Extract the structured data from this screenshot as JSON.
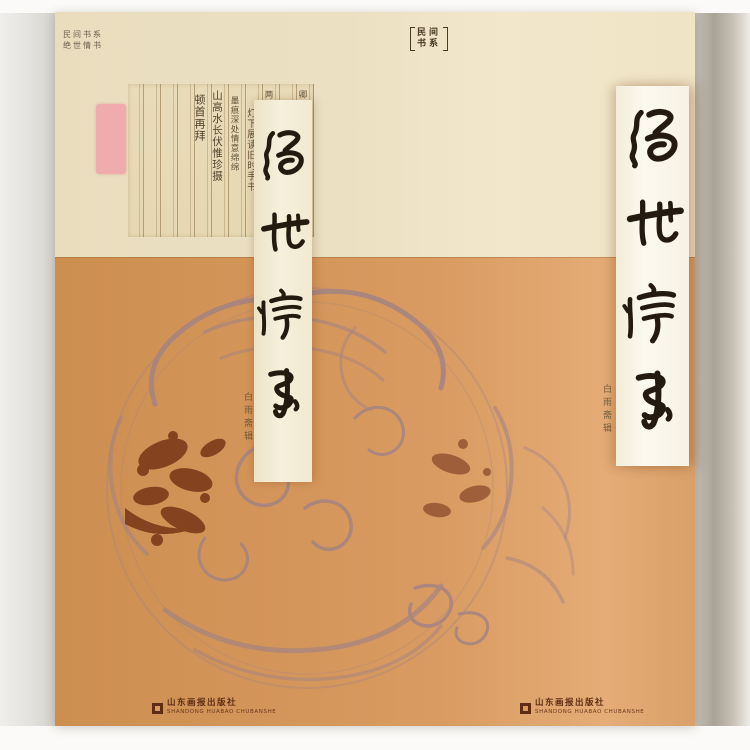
{
  "cover": {
    "series_note_lines": [
      "民间书系",
      "绝世情书"
    ],
    "series_badge": {
      "label": "【民间书系】",
      "line1": "民间",
      "line2": "书系"
    },
    "title": {
      "text": "绝世情书",
      "chars": [
        "绝",
        "世",
        "情",
        "书"
      ]
    },
    "author_note": "白雨斋辑",
    "spine_note": "白雨斋辑",
    "manuscript_columns": [
      "卿卿如晤别来无恙",
      "一纸云笺难寄相思",
      "两地相望各自珍重",
      "灯下展读旧时手书",
      "墨痕深处情意绵绵",
      "山高水长伏惟珍摄",
      "顿首再拜"
    ],
    "publisher": {
      "name": "山东画报出版社",
      "latin": "SHANDONG HUABAO CHUBANSHE"
    },
    "colors": {
      "cream": "#ece0c3",
      "orange": "#d4955a",
      "pattern": "#a08286",
      "pattern_dark": "#7c3a1a",
      "ink": "#241a10",
      "seal_pink": "#f2a3aa"
    }
  }
}
